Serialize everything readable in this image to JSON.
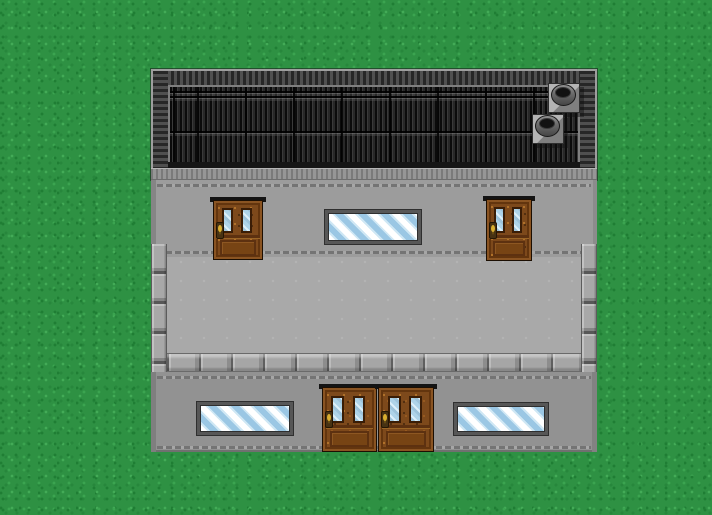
{
  "scene": {
    "description": "Top-down pixel-art RPG exterior map: a large gray stone building with a dark slatted roof sits on speckled green grass. The building has an upper facade with two wooden doors and a striped window, an inner gray courtyard bordered by stone blocks, and a lower facade with two striped windows and a wooden double door.",
    "canvas": {
      "width": 712,
      "height": 515
    },
    "palette": {
      "grass": "#2E9143",
      "grass_dark": "#1F7E34",
      "grass_light": "#3BA450",
      "roof_slats": "#161616",
      "roof_frame_light": "#9E9E9E",
      "roof_frame_dark": "#272727",
      "upper_wall": "#9C9C9C",
      "lower_wall": "#929292",
      "courtyard_floor": "#A9A9A9",
      "stone_block": "#A6A6A6",
      "door_wood": "#7D491B",
      "door_glass": "#AED3E8",
      "window_stripe_blue": "#9BC7E4",
      "window_stripe_white": "#FFFFFF",
      "knob_gold": "#D9AE2F"
    },
    "building": {
      "x": 151,
      "y": 69,
      "width": 446,
      "height": 383
    },
    "objects": {
      "doors": [
        {
          "id": "upper-left-door",
          "kind": "wooden door, two glass panes, gold knob",
          "style": "left:62px;top:128px;width:50px;height:63px"
        },
        {
          "id": "upper-right-door",
          "kind": "wooden door, two glass panes, gold knob",
          "style": "left:335px;top:127px;width:46px;height:65px"
        },
        {
          "id": "lower-double-door-left",
          "kind": "wooden door, two glass panes, gold knob",
          "style": "left:171px;top:315px;width:55px;height:68px"
        },
        {
          "id": "lower-double-door-right",
          "kind": "wooden door, two glass panes, gold knob",
          "style": "left:227px;top:315px;width:56px;height:68px"
        }
      ],
      "windows": [
        {
          "id": "upper-window",
          "kind": "blue-and-white striped glass window",
          "style": "left:174px;top:141px;width:96px;height:34px"
        },
        {
          "id": "lower-left-window",
          "kind": "blue-and-white striped glass window",
          "style": "left:46px;top:333px;width:96px;height:33px"
        },
        {
          "id": "lower-right-window",
          "kind": "blue-and-white striped glass window",
          "style": "left:303px;top:334px;width:94px;height:32px"
        }
      ],
      "chimneys": [
        {
          "id": "chimney-upper",
          "kind": "round roof vent on square base",
          "style": "left:397px;top:14px"
        },
        {
          "id": "chimney-lower",
          "kind": "round roof vent on square base",
          "style": "left:381px;top:45px"
        }
      ],
      "stone_borders": [
        {
          "id": "stone-border-left",
          "blocks": 4
        },
        {
          "id": "stone-border-right",
          "blocks": 4
        },
        {
          "id": "stone-border-bottom",
          "blocks": 13
        }
      ]
    }
  }
}
